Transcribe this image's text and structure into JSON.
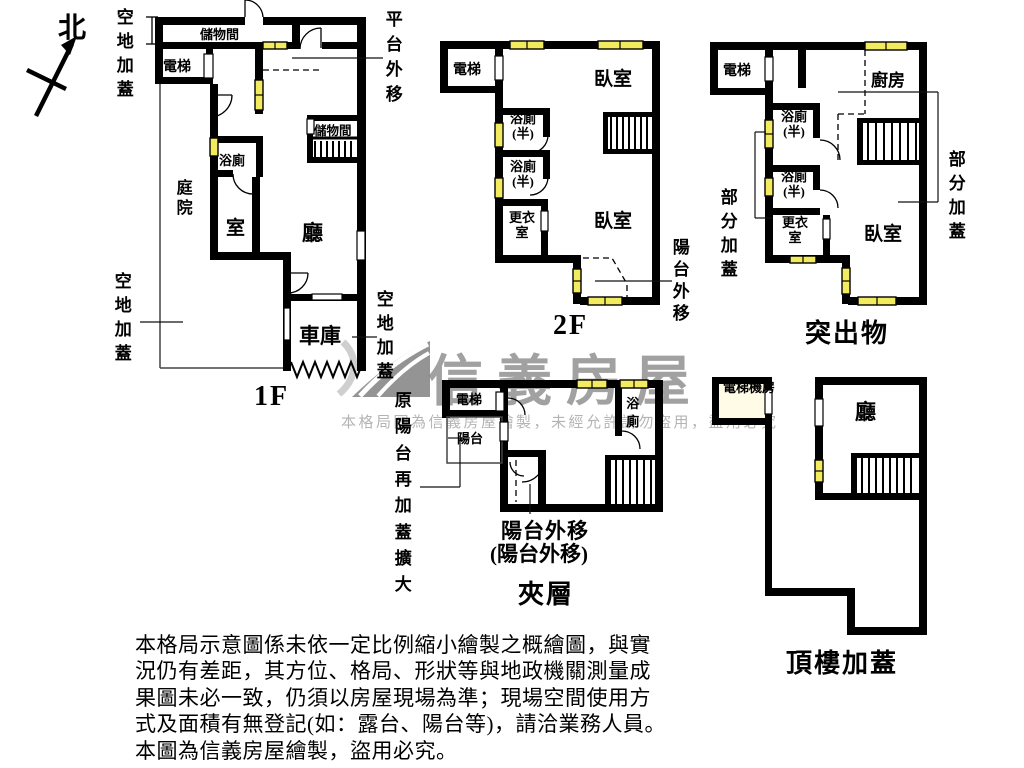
{
  "compass": {
    "north": "北"
  },
  "watermark": {
    "brand": "信義房屋",
    "notice": "本格局圖為信義房屋繪製，未經允許請勿盜用，盜用必究",
    "brand_color": "#9a9a9a"
  },
  "colors": {
    "wall": "#000000",
    "window": "#f3eb5f"
  },
  "plans": {
    "f1": {
      "title": "1F",
      "rooms": {
        "storage_top": "儲物間",
        "elevator": "電梯",
        "storage_right": "儲物間",
        "bath": "浴廁",
        "courtyard": "庭院",
        "room": "室",
        "living": "廳",
        "garage": "車庫"
      },
      "annotations": {
        "open_land_top": "空地加蓋",
        "open_land_left": "空地加蓋",
        "open_land_right": "空地加蓋",
        "platform_out": "平台外移"
      }
    },
    "f2": {
      "title": "2F",
      "rooms": {
        "elevator": "電梯",
        "bedroom_top": "臥室",
        "bath_half_1": "浴廁(半)",
        "bath_half_2": "浴廁(半)",
        "closet": "更衣室",
        "bedroom_bottom": "臥室"
      },
      "annotations": {
        "balcony_out": "陽台外移"
      }
    },
    "protrusion": {
      "title": "突出物",
      "rooms": {
        "elevator": "電梯",
        "kitchen": "廚房",
        "bath_half_1": "浴廁(半)",
        "bath_half_2": "浴廁(半)",
        "closet": "更衣室",
        "bedroom": "臥室"
      },
      "annotations": {
        "partial_cover_left": "部分加蓋",
        "partial_cover_right": "部分加蓋"
      }
    },
    "mezzanine": {
      "title": "夾層",
      "rooms": {
        "elevator": "電梯",
        "balcony": "陽台",
        "bath": "浴廁"
      },
      "annotations": {
        "balcony_out_line1": "陽台外移",
        "balcony_out_line2": "(陽台外移)",
        "original_balcony": "原陽台再加蓋擴大"
      }
    },
    "rooftop": {
      "title": "頂樓加蓋",
      "rooms": {
        "elevator_room": "電梯機房",
        "living": "廳"
      }
    }
  },
  "disclaimer": {
    "line1": "本格局示意圖係未依一定比例縮小繪製之概繪圖，與實",
    "line2": "況仍有差距，其方位、格局、形狀等與地政機關測量成",
    "line3": "果圖未必一致，仍須以房屋現場為準；現場空間使用方",
    "line4": "式及面積有無登記(如：露台、陽台等)，請洽業務人員。",
    "line5": "本圖為信義房屋繪製，盜用必究。"
  }
}
